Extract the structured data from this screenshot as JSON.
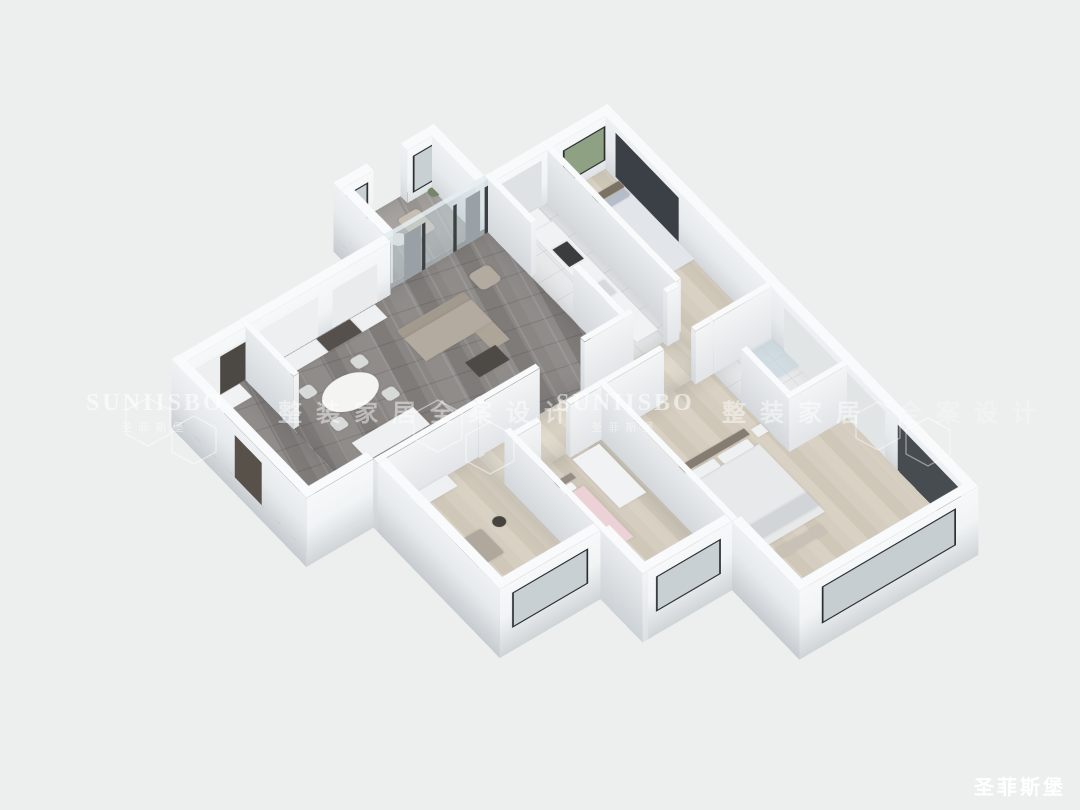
{
  "background": "#edefee",
  "watermarks": {
    "row": [
      {
        "kind": "brand",
        "text": "SUNIISBO",
        "sub": "圣菲斯堡",
        "x": 86,
        "y": 390
      },
      {
        "kind": "cn",
        "text": "整装家居",
        "x": 278,
        "y": 393
      },
      {
        "kind": "cn",
        "text": "全案设计",
        "x": 430,
        "y": 393
      },
      {
        "kind": "brand",
        "text": "SUNIISBO",
        "sub": "圣菲斯堡",
        "x": 556,
        "y": 390
      },
      {
        "kind": "cn",
        "text": "整装家居",
        "x": 722,
        "y": 393
      },
      {
        "kind": "cn",
        "text": "全案设计",
        "x": 898,
        "y": 393,
        "faint": true
      }
    ],
    "corner_logo": "圣菲斯堡"
  },
  "scene": {
    "plan": {
      "w": 780,
      "h": 1000
    },
    "transform": {
      "translate": [
        121,
        360
      ],
      "scale": 0.7,
      "rotateX": 39,
      "rotateZ": -37
    },
    "wall_height": 120,
    "base": 36,
    "floors": [
      {
        "name": "foyer-floor",
        "x": 0,
        "y": 120,
        "w": 120,
        "d": 320,
        "style": "marbleDark"
      },
      {
        "name": "living-dining-floor",
        "x": 120,
        "y": 120,
        "w": 440,
        "d": 320,
        "style": "marbleDark"
      },
      {
        "name": "balcony-floor",
        "x": 380,
        "y": 0,
        "w": 180,
        "d": 120,
        "style": "marbleLight"
      },
      {
        "name": "kitchen-floor",
        "x": 560,
        "y": 120,
        "w": 100,
        "d": 320,
        "style": "tile"
      },
      {
        "name": "bedroom2-floor",
        "x": 660,
        "y": 120,
        "w": 120,
        "d": 400,
        "style": "wood"
      },
      {
        "name": "hallway-floor",
        "x": 300,
        "y": 440,
        "w": 360,
        "d": 80,
        "style": "woodPale"
      },
      {
        "name": "study-floor",
        "x": 120,
        "y": 440,
        "w": 180,
        "d": 300,
        "style": "wood"
      },
      {
        "name": "kids-bedroom-floor",
        "x": 300,
        "y": 520,
        "w": 160,
        "d": 320,
        "style": "wood"
      },
      {
        "name": "master-bedroom-floor",
        "x": 460,
        "y": 520,
        "w": 320,
        "d": 480,
        "style": "wood"
      },
      {
        "name": "bathroom-floor",
        "x": 660,
        "y": 520,
        "w": 120,
        "d": 180,
        "style": "tile"
      }
    ],
    "walls": [
      {
        "name": "ext-wall-north-living",
        "dir": "h",
        "x": 0,
        "y": 120,
        "len": 380,
        "t": 16,
        "shade": "ext",
        "deco": [
          {
            "off": 24,
            "len": 80,
            "z": 0,
            "zh": 88,
            "c": "#e9ebec"
          },
          {
            "off": 130,
            "len": 220,
            "z": 0,
            "zh": 92,
            "c": "#edeff0"
          },
          {
            "off": 245,
            "len": 60,
            "z": 0,
            "zh": 86,
            "c": "#4c4844"
          }
        ]
      },
      {
        "name": "ext-wall-west-balcony",
        "dir": "v",
        "x": 380,
        "y": 0,
        "len": 120,
        "t": 16,
        "shade": "ext"
      },
      {
        "name": "ext-wall-north-balcony-west",
        "dir": "h",
        "x": 380,
        "y": 0,
        "len": 60,
        "t": 16,
        "shade": "ext",
        "deco": [
          {
            "off": 10,
            "len": 40,
            "z": 16,
            "zh": 84,
            "c": "#c9d0d4",
            "frame": true
          }
        ]
      },
      {
        "name": "ext-wall-north-balcony-east",
        "dir": "h",
        "x": 500,
        "y": 0,
        "len": 60,
        "t": 16,
        "shade": "ext",
        "deco": [
          {
            "off": 10,
            "len": 40,
            "z": 16,
            "zh": 84,
            "c": "#c9d0d4",
            "frame": true
          }
        ]
      },
      {
        "name": "ext-wall-east-balcony",
        "dir": "v",
        "x": 544,
        "y": 0,
        "len": 120,
        "t": 16,
        "shade": "ext"
      },
      {
        "name": "ext-wall-north-kitchen",
        "dir": "h",
        "x": 560,
        "y": 120,
        "len": 220,
        "t": 16,
        "shade": "ext",
        "deco": [
          {
            "off": 16,
            "len": 76,
            "z": 20,
            "zh": 78,
            "c": "#8fa183",
            "frame": true
          },
          {
            "off": 130,
            "len": 80,
            "z": 0,
            "zh": 104,
            "c": "#dfe2e4"
          }
        ]
      },
      {
        "name": "ext-wall-east-main",
        "dir": "v",
        "x": 764,
        "y": 120,
        "len": 880,
        "t": 16,
        "shade": "ext",
        "deco": [
          {
            "off": 40,
            "len": 150,
            "z": 6,
            "zh": 100,
            "c": "#3a4046"
          },
          {
            "off": 440,
            "len": 240,
            "z": 0,
            "zh": 104,
            "c": "#e2e5e6"
          },
          {
            "off": 710,
            "len": 150,
            "z": 0,
            "zh": 104,
            "c": "#474c51"
          }
        ]
      },
      {
        "name": "ext-wall-south-master",
        "dir": "h",
        "x": 460,
        "y": 984,
        "len": 320,
        "t": 16,
        "shade": "ext",
        "deco": [
          {
            "off": 40,
            "len": 240,
            "z": 16,
            "zh": 84,
            "c": "#c7ced2",
            "frame": true
          }
        ]
      },
      {
        "name": "ext-wall-west-master",
        "dir": "v",
        "x": 460,
        "y": 840,
        "len": 160,
        "t": 16,
        "shade": "ext"
      },
      {
        "name": "ext-wall-south-kids",
        "dir": "h",
        "x": 300,
        "y": 824,
        "len": 160,
        "t": 16,
        "shade": "ext",
        "deco": [
          {
            "off": 20,
            "len": 116,
            "z": 16,
            "zh": 80,
            "c": "#c9d0d4",
            "frame": true
          }
        ]
      },
      {
        "name": "ext-wall-west-kids",
        "dir": "v",
        "x": 300,
        "y": 740,
        "len": 100,
        "t": 16,
        "shade": "ext"
      },
      {
        "name": "ext-wall-south-study",
        "dir": "h",
        "x": 120,
        "y": 724,
        "len": 180,
        "t": 16,
        "shade": "ext",
        "deco": [
          {
            "off": 22,
            "len": 136,
            "z": 16,
            "zh": 80,
            "c": "#c9d0d4",
            "frame": true
          }
        ]
      },
      {
        "name": "ext-wall-west-study",
        "dir": "v",
        "x": 120,
        "y": 440,
        "len": 300,
        "t": 16,
        "shade": "ext"
      },
      {
        "name": "ext-wall-south-foyer",
        "dir": "h",
        "x": 0,
        "y": 424,
        "len": 120,
        "t": 16,
        "shade": "ext"
      },
      {
        "name": "ext-wall-west-foyer",
        "dir": "v",
        "x": 0,
        "y": 120,
        "len": 320,
        "t": 16,
        "shade": "ext",
        "deco": [
          {
            "off": 150,
            "len": 64,
            "z": 0,
            "zh": 96,
            "c": "#58514a"
          }
        ]
      },
      {
        "name": "int-wall-foyer-living",
        "dir": "v",
        "x": 120,
        "y": 120,
        "len": 130,
        "t": 10,
        "shade": "int"
      },
      {
        "name": "balcony-glass-partition",
        "dir": "h",
        "x": 380,
        "y": 120,
        "len": 180,
        "t": 8,
        "shade": "glass",
        "deco": [
          {
            "off": 0,
            "len": 6,
            "z": 0,
            "zh": 106,
            "c": "#3c4043"
          },
          {
            "off": 56,
            "len": 6,
            "z": 0,
            "zh": 106,
            "c": "#3c4043"
          },
          {
            "off": 112,
            "len": 6,
            "z": 0,
            "zh": 106,
            "c": "#3c4043"
          },
          {
            "off": 174,
            "len": 6,
            "z": 0,
            "zh": 106,
            "c": "#3c4043"
          },
          {
            "off": 14,
            "len": 26,
            "z": 0,
            "zh": 106,
            "c": "#9aa1a6"
          },
          {
            "off": 120,
            "len": 30,
            "z": 0,
            "zh": 106,
            "c": "#9aa1a6"
          }
        ]
      },
      {
        "name": "int-wall-living-kitchen-north",
        "dir": "v",
        "x": 560,
        "y": 120,
        "len": 110,
        "t": 10,
        "shade": "int"
      },
      {
        "name": "int-wall-living-kitchen-south",
        "dir": "v",
        "x": 560,
        "y": 330,
        "len": 110,
        "t": 10,
        "shade": "int"
      },
      {
        "name": "int-wall-kitchen-bedroom2",
        "dir": "v",
        "x": 660,
        "y": 120,
        "len": 320,
        "t": 10,
        "shade": "int"
      },
      {
        "name": "int-wall-study-north",
        "dir": "h",
        "x": 120,
        "y": 440,
        "len": 180,
        "t": 10,
        "shade": "int"
      },
      {
        "name": "int-wall-living-hall-west",
        "dir": "h",
        "x": 300,
        "y": 440,
        "len": 110,
        "t": 10,
        "shade": "int"
      },
      {
        "name": "int-wall-living-hall-east",
        "dir": "h",
        "x": 490,
        "y": 440,
        "len": 70,
        "t": 10,
        "shade": "int"
      },
      {
        "name": "int-wall-kitchen-hall-west",
        "dir": "h",
        "x": 560,
        "y": 440,
        "len": 18,
        "t": 10,
        "shade": "int"
      },
      {
        "name": "int-wall-kitchen-hall-east",
        "dir": "h",
        "x": 638,
        "y": 440,
        "len": 22,
        "t": 10,
        "shade": "int"
      },
      {
        "name": "int-wall-hall-south-1",
        "dir": "h",
        "x": 300,
        "y": 520,
        "len": 52,
        "t": 10,
        "shade": "int"
      },
      {
        "name": "int-wall-hall-south-2",
        "dir": "h",
        "x": 404,
        "y": 520,
        "len": 168,
        "t": 10,
        "shade": "int"
      },
      {
        "name": "int-wall-hall-south-3",
        "dir": "h",
        "x": 628,
        "y": 520,
        "len": 32,
        "t": 10,
        "shade": "int"
      },
      {
        "name": "int-wall-bathroom-north",
        "dir": "h",
        "x": 660,
        "y": 520,
        "len": 104,
        "t": 10,
        "shade": "int"
      },
      {
        "name": "int-wall-study-east-north",
        "dir": "v",
        "x": 300,
        "y": 440,
        "len": 12,
        "t": 10,
        "shade": "int"
      },
      {
        "name": "int-wall-study-east-south",
        "dir": "v",
        "x": 300,
        "y": 512,
        "len": 328,
        "t": 10,
        "shade": "int"
      },
      {
        "name": "int-wall-kids-master",
        "dir": "v",
        "x": 460,
        "y": 520,
        "len": 320,
        "t": 10,
        "shade": "int"
      },
      {
        "name": "int-wall-bathroom-south",
        "dir": "h",
        "x": 660,
        "y": 700,
        "len": 104,
        "t": 10,
        "shade": "int"
      },
      {
        "name": "int-wall-bathroom-west",
        "dir": "v",
        "x": 660,
        "y": 596,
        "len": 104,
        "t": 10,
        "shade": "int"
      }
    ],
    "furniture": [
      {
        "name": "foyer-shoe-cabinet",
        "x": 12,
        "y": 138,
        "w": 96,
        "d": 30,
        "c": "#f1f2f3"
      },
      {
        "name": "living-cabinet-strip",
        "x": 130,
        "y": 138,
        "w": 220,
        "d": 30,
        "c": "#eef0f1"
      },
      {
        "name": "living-display-shelf",
        "x": 245,
        "y": 138,
        "w": 60,
        "d": 30,
        "c": "#55504b"
      },
      {
        "name": "dining-table",
        "x": 180,
        "y": 215,
        "w": 90,
        "d": 62,
        "c": "#f4f4f2",
        "r": "50%"
      },
      {
        "name": "dining-chair",
        "x": 166,
        "y": 198,
        "w": 22,
        "d": 22,
        "c": "#d8dad9",
        "r": "6px"
      },
      {
        "name": "dining-chair",
        "x": 258,
        "y": 198,
        "w": 22,
        "d": 22,
        "c": "#d8dad9",
        "r": "6px"
      },
      {
        "name": "dining-chair",
        "x": 166,
        "y": 272,
        "w": 22,
        "d": 22,
        "c": "#d8dad9",
        "r": "6px"
      },
      {
        "name": "dining-chair",
        "x": 258,
        "y": 272,
        "w": 22,
        "d": 22,
        "c": "#d8dad9",
        "r": "6px"
      },
      {
        "name": "kitchen-island",
        "x": 170,
        "y": 322,
        "w": 110,
        "d": 40,
        "c": "#eef0f1"
      },
      {
        "name": "sofa-back",
        "x": 345,
        "y": 196,
        "w": 120,
        "d": 18,
        "c": "#a29a8e",
        "r": "4px"
      },
      {
        "name": "sofa-seat",
        "x": 345,
        "y": 214,
        "w": 120,
        "d": 52,
        "c": "#b3ab9f"
      },
      {
        "name": "sofa-chaise",
        "x": 433,
        "y": 266,
        "w": 32,
        "d": 40,
        "c": "#ada598"
      },
      {
        "name": "armchair",
        "x": 487,
        "y": 176,
        "w": 36,
        "d": 36,
        "c": "#b3ab9f",
        "r": "8px"
      },
      {
        "name": "coffee-table",
        "x": 388,
        "y": 302,
        "w": 54,
        "d": 34,
        "c": "#4d4a46"
      },
      {
        "name": "tv-console",
        "x": 308,
        "y": 408,
        "w": 96,
        "d": 20,
        "c": "#8d8a86"
      },
      {
        "name": "tv-screen",
        "x": 316,
        "y": 412,
        "w": 80,
        "d": 11,
        "c": "#222426"
      },
      {
        "name": "balcony-lounge-chair",
        "x": 468,
        "y": 34,
        "w": 36,
        "d": 46,
        "c": "#c6bfb1",
        "r": "6px"
      },
      {
        "name": "balcony-side-table",
        "x": 436,
        "y": 52,
        "w": 24,
        "d": 24,
        "c": "#e8e9e7",
        "r": "50%"
      },
      {
        "name": "balcony-plant",
        "x": 390,
        "y": 12,
        "w": 20,
        "d": 20,
        "c": "#7e9070",
        "r": "50%"
      },
      {
        "name": "balcony-plant",
        "x": 532,
        "y": 16,
        "w": 18,
        "d": 18,
        "c": "#74866a",
        "r": "50%"
      },
      {
        "name": "kitchen-counter-north",
        "x": 578,
        "y": 138,
        "w": 64,
        "d": 32,
        "c": "#f0f2f3"
      },
      {
        "name": "kitchen-counter-east",
        "x": 606,
        "y": 170,
        "w": 38,
        "d": 250,
        "c": "#f0f2f3"
      },
      {
        "name": "kitchen-stove",
        "x": 612,
        "y": 212,
        "w": 26,
        "d": 40,
        "c": "#3a3c3e"
      },
      {
        "name": "kitchen-sink",
        "x": 612,
        "y": 300,
        "w": 26,
        "d": 30,
        "c": "#d7dadc"
      },
      {
        "name": "bedroom2-headboard",
        "x": 676,
        "y": 168,
        "w": 88,
        "d": 14,
        "c": "#7b7266"
      },
      {
        "name": "bedroom2-duvet",
        "x": 676,
        "y": 198,
        "w": 88,
        "d": 150,
        "c": "#e2e5e9",
        "cls": "duvet"
      },
      {
        "name": "bedroom2-pillow",
        "x": 682,
        "y": 184,
        "w": 36,
        "d": 16,
        "c": "#b4bdc9",
        "r": "3px"
      },
      {
        "name": "bedroom2-pillow",
        "x": 724,
        "y": 184,
        "w": 36,
        "d": 16,
        "c": "#b4bdc9",
        "r": "3px"
      },
      {
        "name": "bedroom2-wardrobe",
        "x": 680,
        "y": 460,
        "w": 84,
        "d": 34,
        "c": "#f1f2f3"
      },
      {
        "name": "study-sofa",
        "x": 148,
        "y": 560,
        "w": 74,
        "d": 56,
        "c": "#b0a89c",
        "r": "4px"
      },
      {
        "name": "study-floor-lamp",
        "x": 240,
        "y": 556,
        "w": 20,
        "d": 20,
        "c": "#46433f",
        "r": "50%"
      },
      {
        "name": "study-shelf",
        "x": 132,
        "y": 452,
        "w": 110,
        "d": 26,
        "c": "#eef0f1"
      },
      {
        "name": "kids-bed-headboard",
        "x": 312,
        "y": 556,
        "w": 74,
        "d": 12,
        "c": "#948d84"
      },
      {
        "name": "kids-bed-duvet",
        "x": 312,
        "y": 586,
        "w": 74,
        "d": 118,
        "c": "#ecd2d6",
        "cls": "duvet"
      },
      {
        "name": "kids-pillow",
        "x": 320,
        "y": 570,
        "w": 56,
        "d": 14,
        "c": "#f4f5f6",
        "r": "3px"
      },
      {
        "name": "kids-wardrobe",
        "x": 402,
        "y": 538,
        "w": 48,
        "d": 112,
        "c": "#f1f2f3"
      },
      {
        "name": "master-wardrobe",
        "x": 472,
        "y": 700,
        "w": 26,
        "d": 150,
        "c": "#f0f1f2"
      },
      {
        "name": "master-bed-headboard",
        "x": 500,
        "y": 640,
        "w": 132,
        "d": 14,
        "c": "#857c72"
      },
      {
        "name": "master-bed-duvet",
        "x": 500,
        "y": 676,
        "w": 132,
        "d": 156,
        "c": "#e7e9ea",
        "cls": "duvet"
      },
      {
        "name": "master-pillow",
        "x": 510,
        "y": 658,
        "w": 54,
        "d": 18,
        "c": "#eef0f2",
        "r": "3px"
      },
      {
        "name": "master-pillow",
        "x": 570,
        "y": 658,
        "w": 54,
        "d": 18,
        "c": "#eef0f2",
        "r": "3px"
      },
      {
        "name": "master-bed-throw",
        "x": 500,
        "y": 788,
        "w": 132,
        "d": 30,
        "c": "#d2d5d7"
      },
      {
        "name": "master-bench",
        "x": 520,
        "y": 846,
        "w": 92,
        "d": 18,
        "c": "#c7c1b6"
      },
      {
        "name": "master-nightstand",
        "x": 638,
        "y": 648,
        "w": 18,
        "d": 18,
        "c": "#f0f1f2"
      },
      {
        "name": "bathroom-shower",
        "x": 722,
        "y": 534,
        "w": 42,
        "d": 62,
        "c": "rgba(190,210,218,0.55)"
      },
      {
        "name": "bathroom-toilet",
        "x": 676,
        "y": 606,
        "w": 24,
        "d": 34,
        "c": "#f5f6f7",
        "r": "8px"
      },
      {
        "name": "bathroom-vanity",
        "x": 676,
        "y": 654,
        "w": 72,
        "d": 30,
        "c": "#eef0f1"
      }
    ]
  }
}
